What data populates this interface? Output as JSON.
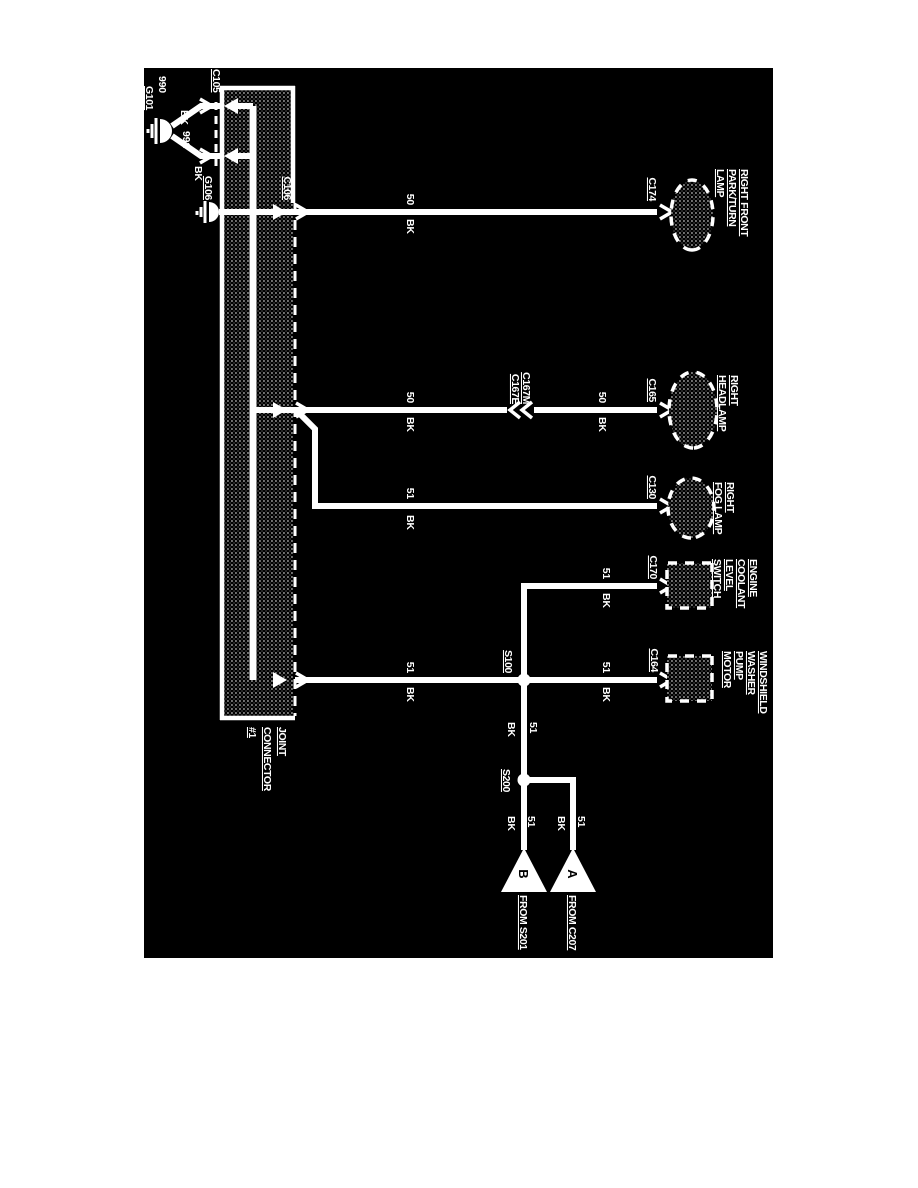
{
  "document": {
    "kind": "ground distribution wiring diagram",
    "colors": {
      "paper": "#ffffff",
      "background": "#000000",
      "ink": "#ffffff"
    }
  },
  "diagram": {
    "joint_connector": {
      "label_lines": [
        "JOINT",
        "CONNECTOR",
        "#1"
      ]
    },
    "connectors": {
      "c105": "C105",
      "c106": "C106",
      "c174": "C174",
      "c165": "C165",
      "c167m": "C167M",
      "c167e": "C167E",
      "c130": "C130",
      "c170": "C170",
      "c164": "C164"
    },
    "grounds": {
      "g101": "G101",
      "g106": "G106"
    },
    "splices": {
      "s100": "S100",
      "s200": "S200"
    },
    "offpage": {
      "a": {
        "letter": "A",
        "label": "FROM C207"
      },
      "b": {
        "letter": "B",
        "label": "FROM S201"
      }
    },
    "components": {
      "park_turn_lamp": {
        "lines": [
          "RIGHT FRONT",
          "PARK/TURN",
          "LAMP"
        ]
      },
      "headlamp": {
        "lines": [
          "RIGHT",
          "HEADLAMP"
        ]
      },
      "fog_lamp": {
        "lines": [
          "RIGHT",
          "FOG LAMP"
        ]
      },
      "coolant_switch": {
        "lines": [
          "ENGINE",
          "COOLANT",
          "LEVEL",
          "SWITCH"
        ]
      },
      "washer_motor": {
        "lines": [
          "WINDSHIELD",
          "WASHER",
          "PUMP",
          "MOTOR"
        ]
      }
    },
    "wires": {
      "g101_a": {
        "circuit": "990",
        "color": "BK"
      },
      "g101_b": {
        "circuit": "991",
        "color": "BK"
      },
      "park_turn": {
        "circuit": "50",
        "color": "BK"
      },
      "headlamp_upper": {
        "circuit": "50",
        "color": "BK"
      },
      "headlamp_lower": {
        "circuit": "50",
        "color": "BK"
      },
      "fog": {
        "circuit": "51",
        "color": "BK"
      },
      "coolant": {
        "circuit": "51",
        "color": "BK"
      },
      "washer": {
        "circuit": "51",
        "color": "BK"
      },
      "box_s100": {
        "circuit": "51",
        "color": "BK"
      },
      "s100_s200": {
        "circuit": "51",
        "color": "BK"
      },
      "s200_b": {
        "circuit": "51",
        "color": "BK"
      },
      "s200_a": {
        "circuit": "51",
        "color": "BK"
      }
    }
  }
}
